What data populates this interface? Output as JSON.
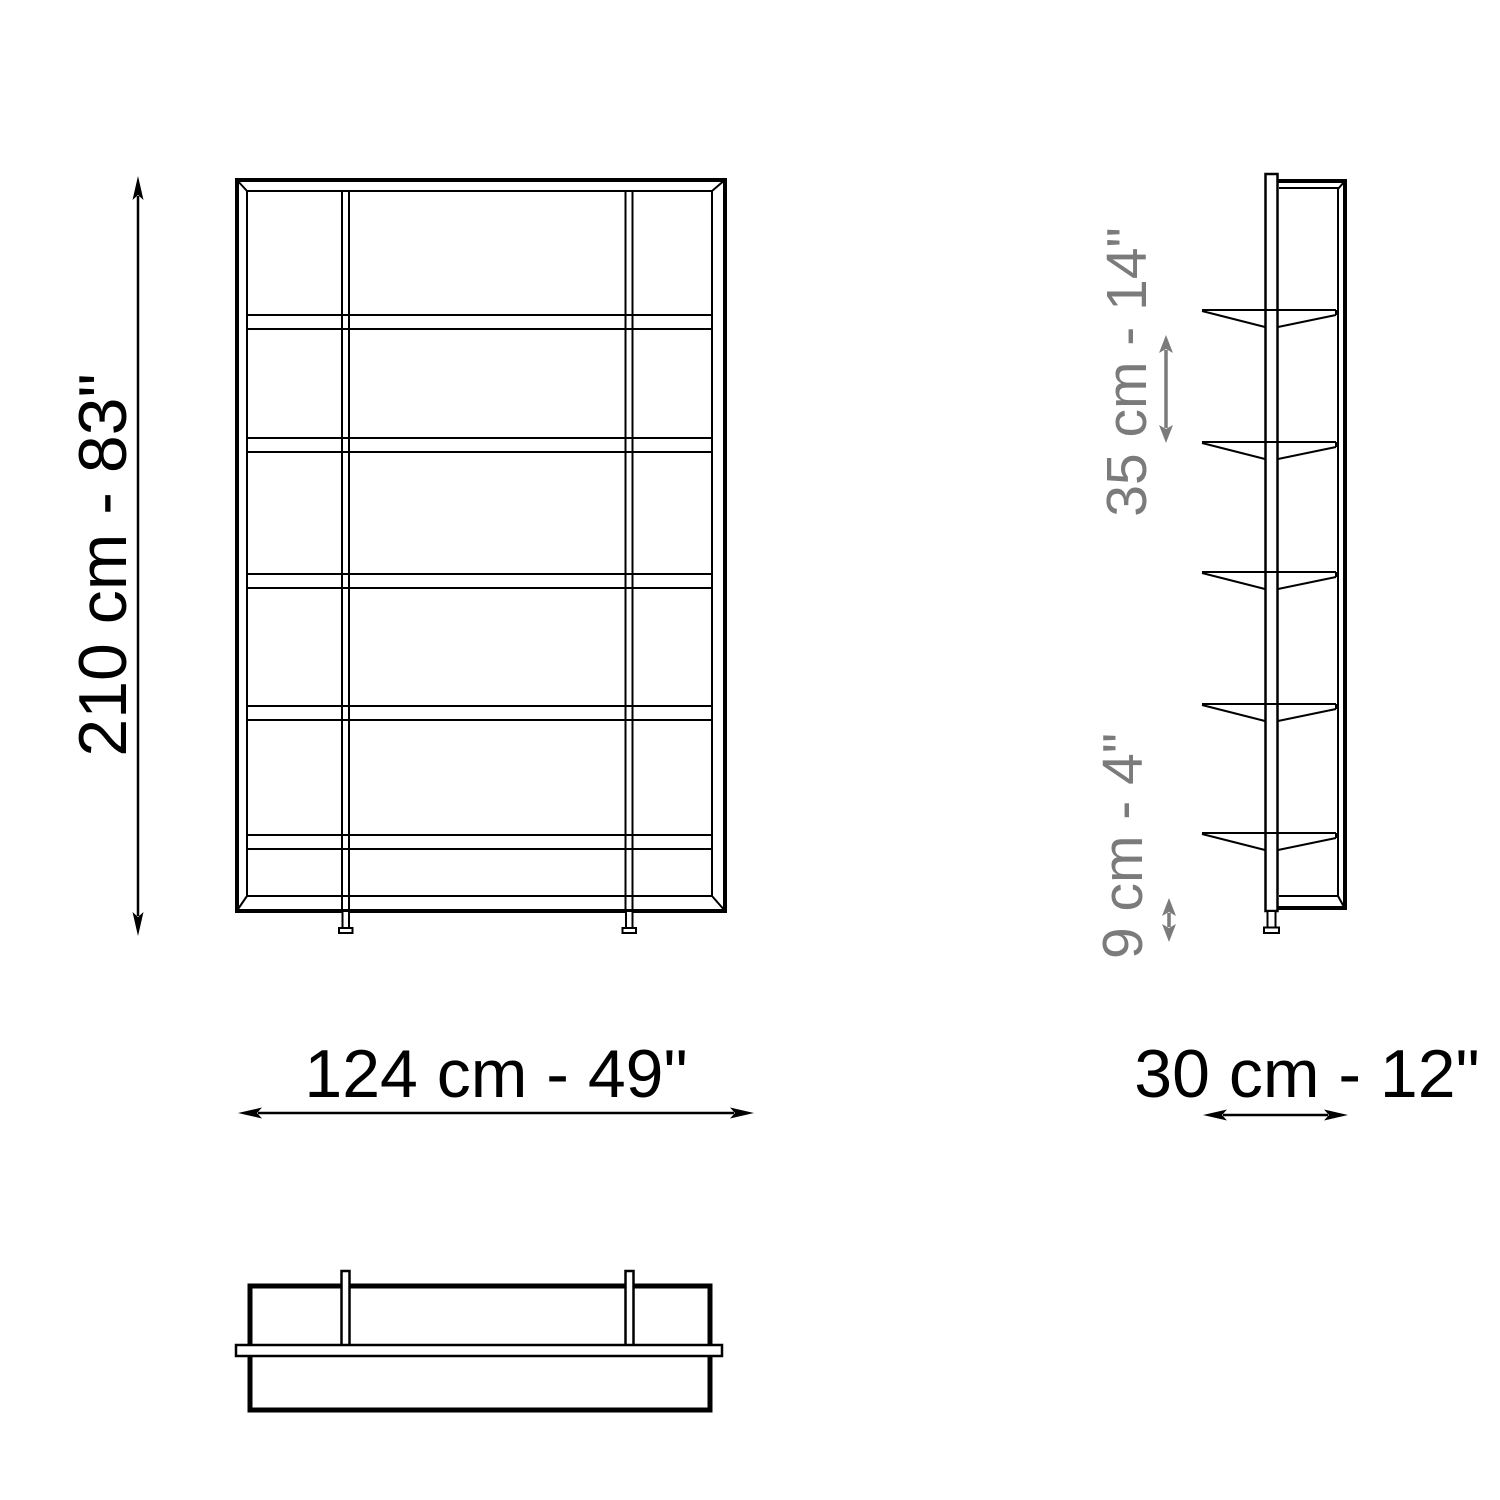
{
  "colors": {
    "line": "#000000",
    "annotation": "#7b7b7b",
    "background": "#ffffff"
  },
  "dimensions": {
    "height": "210 cm - 83\"",
    "width": "124 cm - 49\"",
    "depth": "30 cm - 12\"",
    "shelf_gap": "35 cm - 14\"",
    "base_height": "9 cm - 4\""
  }
}
